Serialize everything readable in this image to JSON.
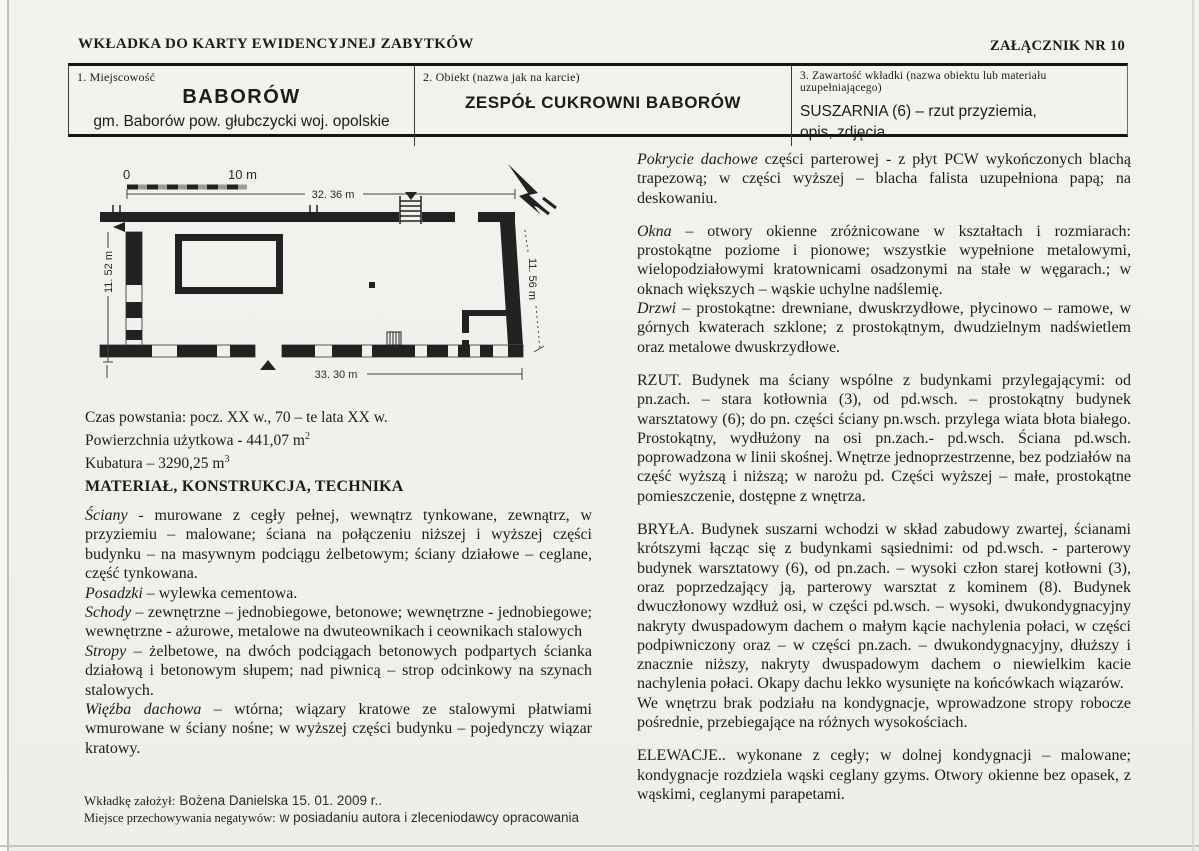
{
  "header": {
    "title": "WKŁADKA DO KARTY EWIDENCYJNEJ ZABYTKÓW",
    "attachment": "ZAŁĄCZNIK NR 10"
  },
  "info_table": {
    "col1_label": "1.  Miejscowość",
    "col1_name": "BABORÓW",
    "col1_sub": "gm. Baborów  pow. głubczycki    woj. opolskie",
    "col2_label": "2.    Obiekt (nazwa jak na karcie)",
    "col2_name": "ZESPÓŁ CUKROWNI BABORÓW",
    "col3_label": "3.  Zawartość wkładki (nazwa obiektu lub materiału uzupełniającego)",
    "col3_name_line1": "SUSZARNIA (6) – rzut przyziemia,",
    "col3_name_line2": "opis, zdjęcia"
  },
  "plan": {
    "scale_zero": "0",
    "scale_ten": "10 m",
    "dim_top": "32. 36 m",
    "dim_bottom": "33. 30 m",
    "dim_left": "11. 52 m",
    "dim_right": "11. 56 m"
  },
  "facts": [
    {
      "text": "Czas powstania: pocz. XX w., 70 – te lata XX w.",
      "sup": ""
    },
    {
      "text": "Powierzchnia użytkowa  - 441,07 m",
      "sup": "2"
    },
    {
      "text": "Kubatura – 3290,25 m",
      "sup": "3"
    }
  ],
  "section_title": "MATERIAŁ, KONSTRUKCJA, TECHNIKA",
  "material": {
    "paragraphs": [
      {
        "lead": "Ściany",
        "rest": " -  murowane  z  cegły  pełnej,  wewnątrz  tynkowane,  zewnątrz, w przyziemiu – malowane;  ściana na połączeniu niższej  i wyższej części budynku – na masywnym  podciągu  żelbetowym;  ściany  działowe – ceglane, część tynkowana."
      },
      {
        "lead": "Posadzki",
        "rest": " – wylewka cementowa."
      },
      {
        "lead": "Schody",
        "rest": " – zewnętrzne – jednobiegowe,  betonowe; wewnętrzne - jednobiegowe; wewnętrzne -  ażurowe,  metalowe na dwuteownikach i ceownikach stalowych"
      },
      {
        "lead": "Stropy",
        "rest": " –  żelbetowe,  na  dwóch  podciągach  betonowych  podpartych  ścianka działową i betonowym słupem;   nad piwnicą – strop odcinkowy na szynach stalowych."
      },
      {
        "lead": "Więźba dachowa",
        "rest": " –  wtórna;  wiązary  kratowe  ze  stalowymi  płatwiami wmurowane w ściany nośne; w wyższej części budynku – pojedynczy wiązar kratowy."
      }
    ]
  },
  "right_column": {
    "paragraphs": [
      {
        "lead": "Pokrycie dachowe",
        "rest": " części parterowej - z płyt PCW wykończonych blachą trapezową;  w części wyższej – blacha falista uzupełniona papą; na deskowaniu."
      },
      {
        "lead": "Okna",
        "rest": " – otwory okienne zróżnicowane w kształtach i rozmiarach: prostokątne poziome i pionowe; wszystkie wypełnione metalowymi, wielopodziałowymi kratownicami osadzonymi na stałe w węgarach.; w oknach większych – wąskie uchylne nadślemię."
      },
      {
        "lead": "Drzwi",
        "rest": " – prostokątne: drewniane, dwuskrzydłowe, płycinowo – ramowe, w górnych kwaterach szklone; z prostokątnym, dwudzielnym nadświetlem oraz metalowe dwuskrzydłowe."
      },
      {
        "lead": "",
        "rest": "RZUT. Budynek ma ściany wspólne z budynkami przylegającymi: od pn.zach. – stara kotłownia (3),   od pd.wsch. – prostokątny budynek warsztatowy (6); do pn. części ściany pn.wsch. przylega wiata błota białego.   Prostokątny, wydłużony na osi pn.zach.- pd.wsch. Ściana pd.wsch. poprowadzona w linii skośnej.  Wnętrze jednoprzestrzenne, bez podziałów na część wyższą i niższą; w narożu pd. Części wyższej – małe, prostokątne pomieszczenie, dostępne z wnętrza."
      },
      {
        "lead": "",
        "rest": "BRYŁA. Budynek suszarni wchodzi w skład zabudowy zwartej, ścianami krótszymi łącząc się z budynkami sąsiednimi:   od pd.wsch. -   parterowy budynek warsztatowy (6), od pn.zach. – wysoki człon starej kotłowni (3), oraz poprzedzający ją, parterowy warsztat z kominem (8).  Budynek dwuczłonowy wzdłuż osi,   w części pd.wsch.   – wysoki, dwukondygnacyjny nakryty dwuspadowym dachem o małym kącie nachylenia połaci, w części podpiwniczony oraz – w części pn.zach. – dwukondygnacyjny, dłuższy i znacznie niższy, nakryty dwuspadowym dachem o niewielkim kacie nachylenia połaci.  Okapy dachu lekko wysunięte na końcówkach wiązarów."
      },
      {
        "lead": "",
        "rest": "We wnętrzu brak podziału na kondygnacje, wprowadzone stropy robocze pośrednie, przebiegające na różnych wysokościach."
      },
      {
        "lead": "",
        "rest": "ELEWACJE..  wykonane  z  cegły;  w  dolnej  kondygnacji  –  malowane; kondygnacje rozdziela wąski ceglany gzyms. Otwory okienne bez opasek, z wąskimi, ceglanymi parapetami."
      }
    ]
  },
  "footer": {
    "line1_label": "Wkładkę założył:",
    "line1_value": "Bożena Danielska 15. 01. 2009 r..",
    "line2_label": "Miejsce przechowywania negatywów:",
    "line2_value": "w  posiadaniu autora i  zleceniodawcy opracowania"
  }
}
